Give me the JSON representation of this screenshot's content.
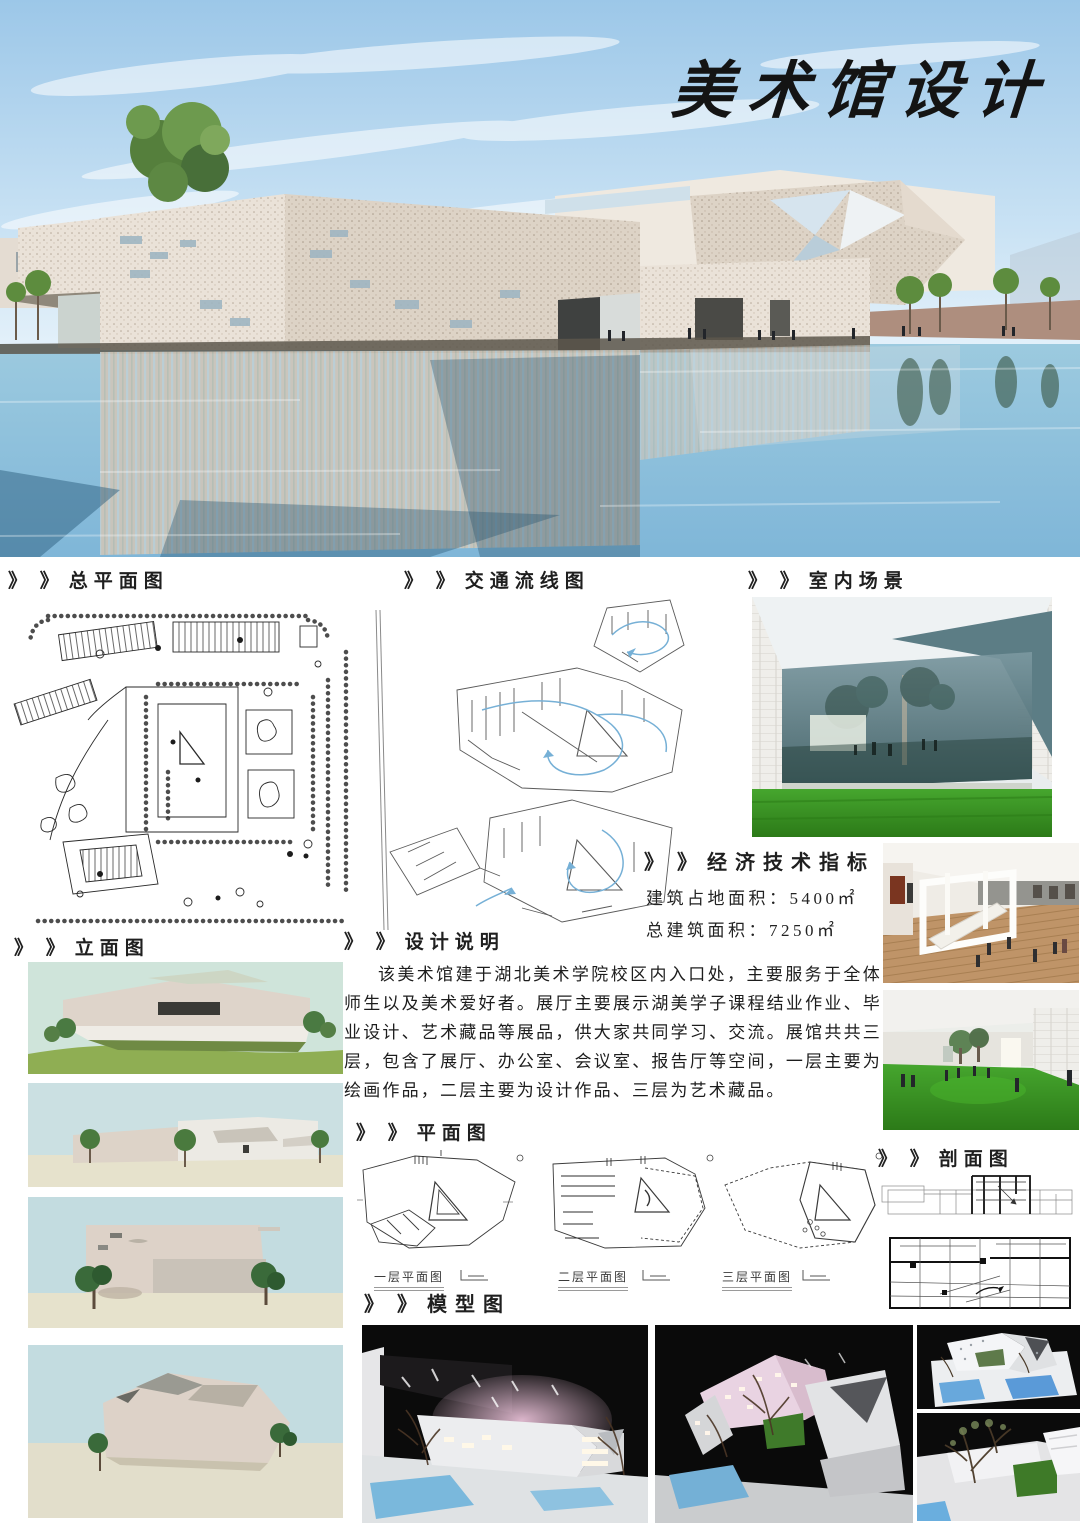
{
  "board": {
    "title": "美术馆设计"
  },
  "sections": {
    "site_plan": {
      "prefix": "》 》",
      "label": "总平面图"
    },
    "traffic": {
      "prefix": "》 》",
      "label": "交通流线图"
    },
    "interior": {
      "prefix": "》 》",
      "label": "室内场景"
    },
    "metrics": {
      "prefix": "》 》",
      "label": "经济技术指标",
      "rows": [
        {
          "text": "建筑占地面积：5400㎡"
        },
        {
          "text": "总建筑面积：7250㎡"
        }
      ]
    },
    "elevation": {
      "prefix": "》 》",
      "label": "立面图"
    },
    "design_note": {
      "prefix": "》 》",
      "label": "设计说明",
      "body": "该美术馆建于湖北美术学院校区内入口处，主要服务于全体师生以及美术爱好者。展厅主要展示湖美学子课程结业作业、毕业设计、艺术藏品等展品，供大家共同学习、交流。展馆共共三层，包含了展厅、办公室、会议室、报告厅等空间，一层主要为绘画作品，二层主要为设计作品、三层为艺术藏品。"
    },
    "plans": {
      "prefix": "》 》",
      "label": "平面图",
      "items": [
        {
          "caption": "一层平面图"
        },
        {
          "caption": "二层平面图"
        },
        {
          "caption": "三层平面图"
        }
      ]
    },
    "section_drawing": {
      "prefix": "》 》",
      "label": "剖面图"
    },
    "models": {
      "prefix": "》 》",
      "label": "模型图"
    }
  },
  "colors": {
    "sky": "#9cc7e8",
    "water": "#8fc3de",
    "facade": "#e9e1d6",
    "flow_line": "#76b0d6",
    "grass": "#3fa02a",
    "model_bg": "#0b0b0b"
  }
}
